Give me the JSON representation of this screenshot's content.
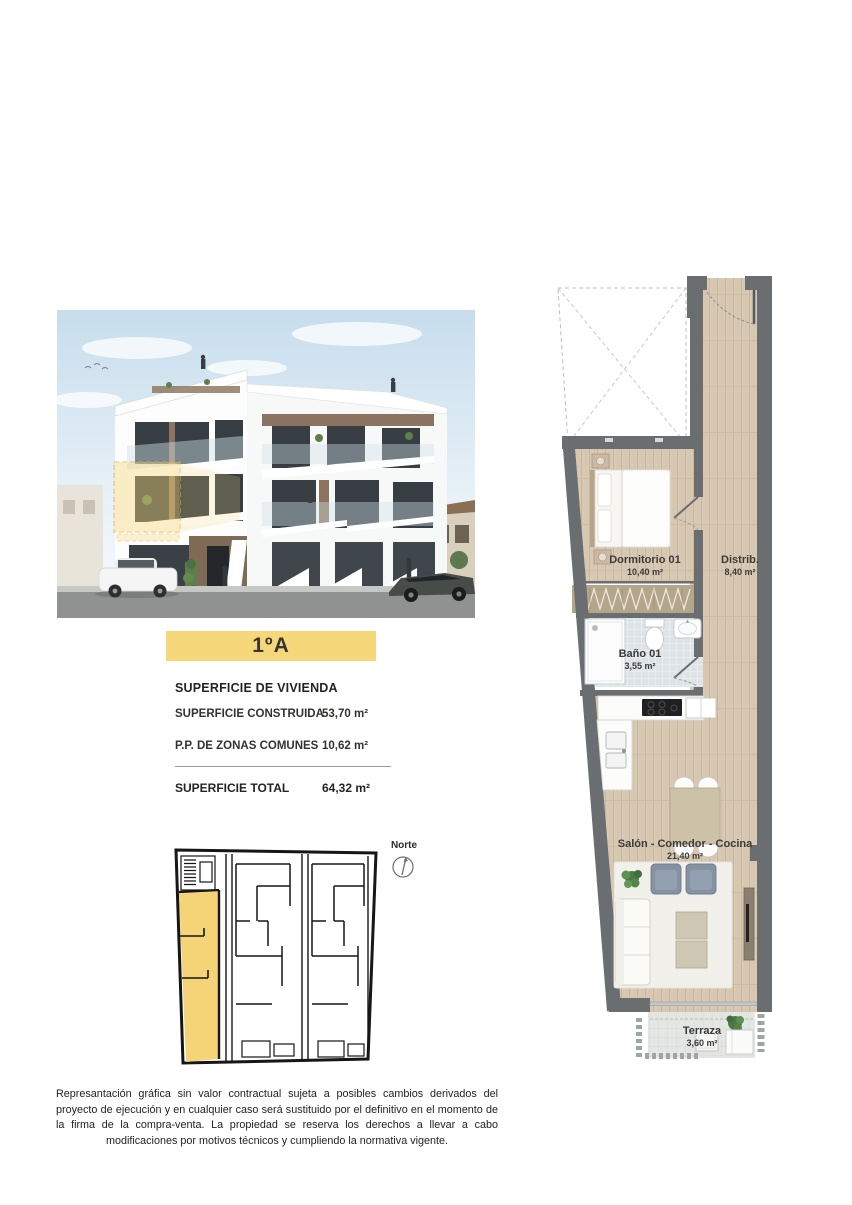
{
  "unit_banner": {
    "label": "1ºA"
  },
  "surface_panel": {
    "title": "SUPERFICIE DE VIVIENDA",
    "rows": [
      {
        "label": "SUPERFICIE CONSTRUIDA",
        "value": "53,70 m²"
      },
      {
        "label": "P.P. DE ZONAS COMUNES",
        "value": "10,62 m²"
      }
    ],
    "total_label": "SUPERFICIE TOTAL",
    "total_value": "64,32 m²"
  },
  "floor_plan": {
    "rooms": [
      {
        "name": "Dormitorio 01",
        "area": "10,40 m²"
      },
      {
        "name": "Distrib.",
        "area": "8,40 m²"
      },
      {
        "name": "Baño 01",
        "area": "3,55 m²"
      },
      {
        "name": "Salón - Comedor - Cocina",
        "area": "21,40 m²"
      },
      {
        "name": "Terraza",
        "area": "3,60 m²"
      }
    ]
  },
  "keyplan": {
    "north_label": "Norte"
  },
  "disclaimer": "Represantación gráfica sin valor contractual sujeta a posibles cambios derivados del proyecto de ejecución y en cualquier caso será sustituido por el definitivo en el momento de la firma de la compra-venta. La propiedad se reserva los derechos a llevar a cabo modificaciones por motivos técnicos y cumpliendo la normativa vigente.",
  "colors": {
    "accent_yellow": "#F6D87A",
    "keyplan_yellow": "#F5D377",
    "wall_gray": "#6A6E70",
    "wood_floor": "#D8C9B4",
    "bath_floor": "#DDE3E6",
    "terrace_floor": "#E4E6E4",
    "text_dark": "#262420"
  }
}
